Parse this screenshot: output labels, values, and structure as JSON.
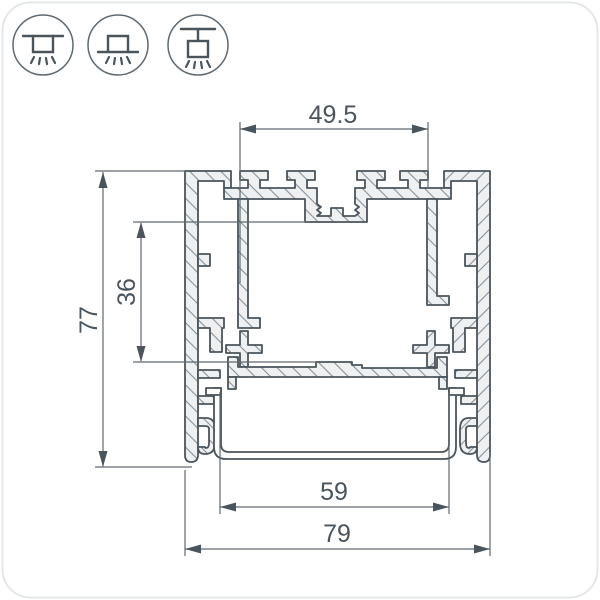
{
  "drawing": {
    "type": "profile-cross-section-dimension-drawing",
    "dimensions": {
      "top_slot_width": "49.5",
      "inner_height": "36",
      "overall_height": "77",
      "diffuser_width": "59",
      "overall_width": "79"
    },
    "mounting_icons": [
      {
        "name": "recessed-mounting"
      },
      {
        "name": "surface-mounting"
      },
      {
        "name": "suspended-mounting"
      }
    ],
    "colors": {
      "background": "#ffffff",
      "card_border": "#e4e7e9",
      "outline": "#4a545c",
      "thin_line": "#5f6970",
      "material_fill": "#eef0f1",
      "hatch_tick": "#8a9299",
      "text": "#4a545c"
    }
  }
}
